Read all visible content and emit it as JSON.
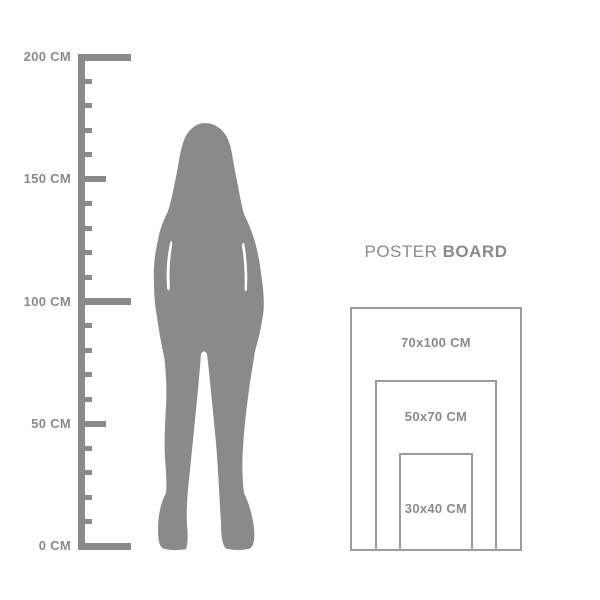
{
  "colors": {
    "background": "#ffffff",
    "gray": "#8a8a8a",
    "outline": "#9c9c9c"
  },
  "title": {
    "regular": "POSTER",
    "bold": "BOARD"
  },
  "unit": "CM",
  "ruler": {
    "min_cm": 0,
    "max_cm": 200,
    "step_cm": 10,
    "major_cms": [
      0,
      100,
      200
    ],
    "medium_cms": [
      50,
      150
    ],
    "labels": [
      {
        "cm": 200,
        "text": "200 CM"
      },
      {
        "cm": 150,
        "text": "150 CM"
      },
      {
        "cm": 100,
        "text": "100 CM"
      },
      {
        "cm": 50,
        "text": "50 CM"
      },
      {
        "cm": 0,
        "text": "0 CM"
      }
    ]
  },
  "figure": {
    "name": "woman silhouette"
  },
  "poster_board": {
    "sizes": [
      {
        "label": "70x100 CM",
        "w_cm": 70,
        "h_cm": 100
      },
      {
        "label": "50x70 CM",
        "w_cm": 50,
        "h_cm": 70
      },
      {
        "label": "30x40 CM",
        "w_cm": 30,
        "h_cm": 40
      }
    ]
  }
}
